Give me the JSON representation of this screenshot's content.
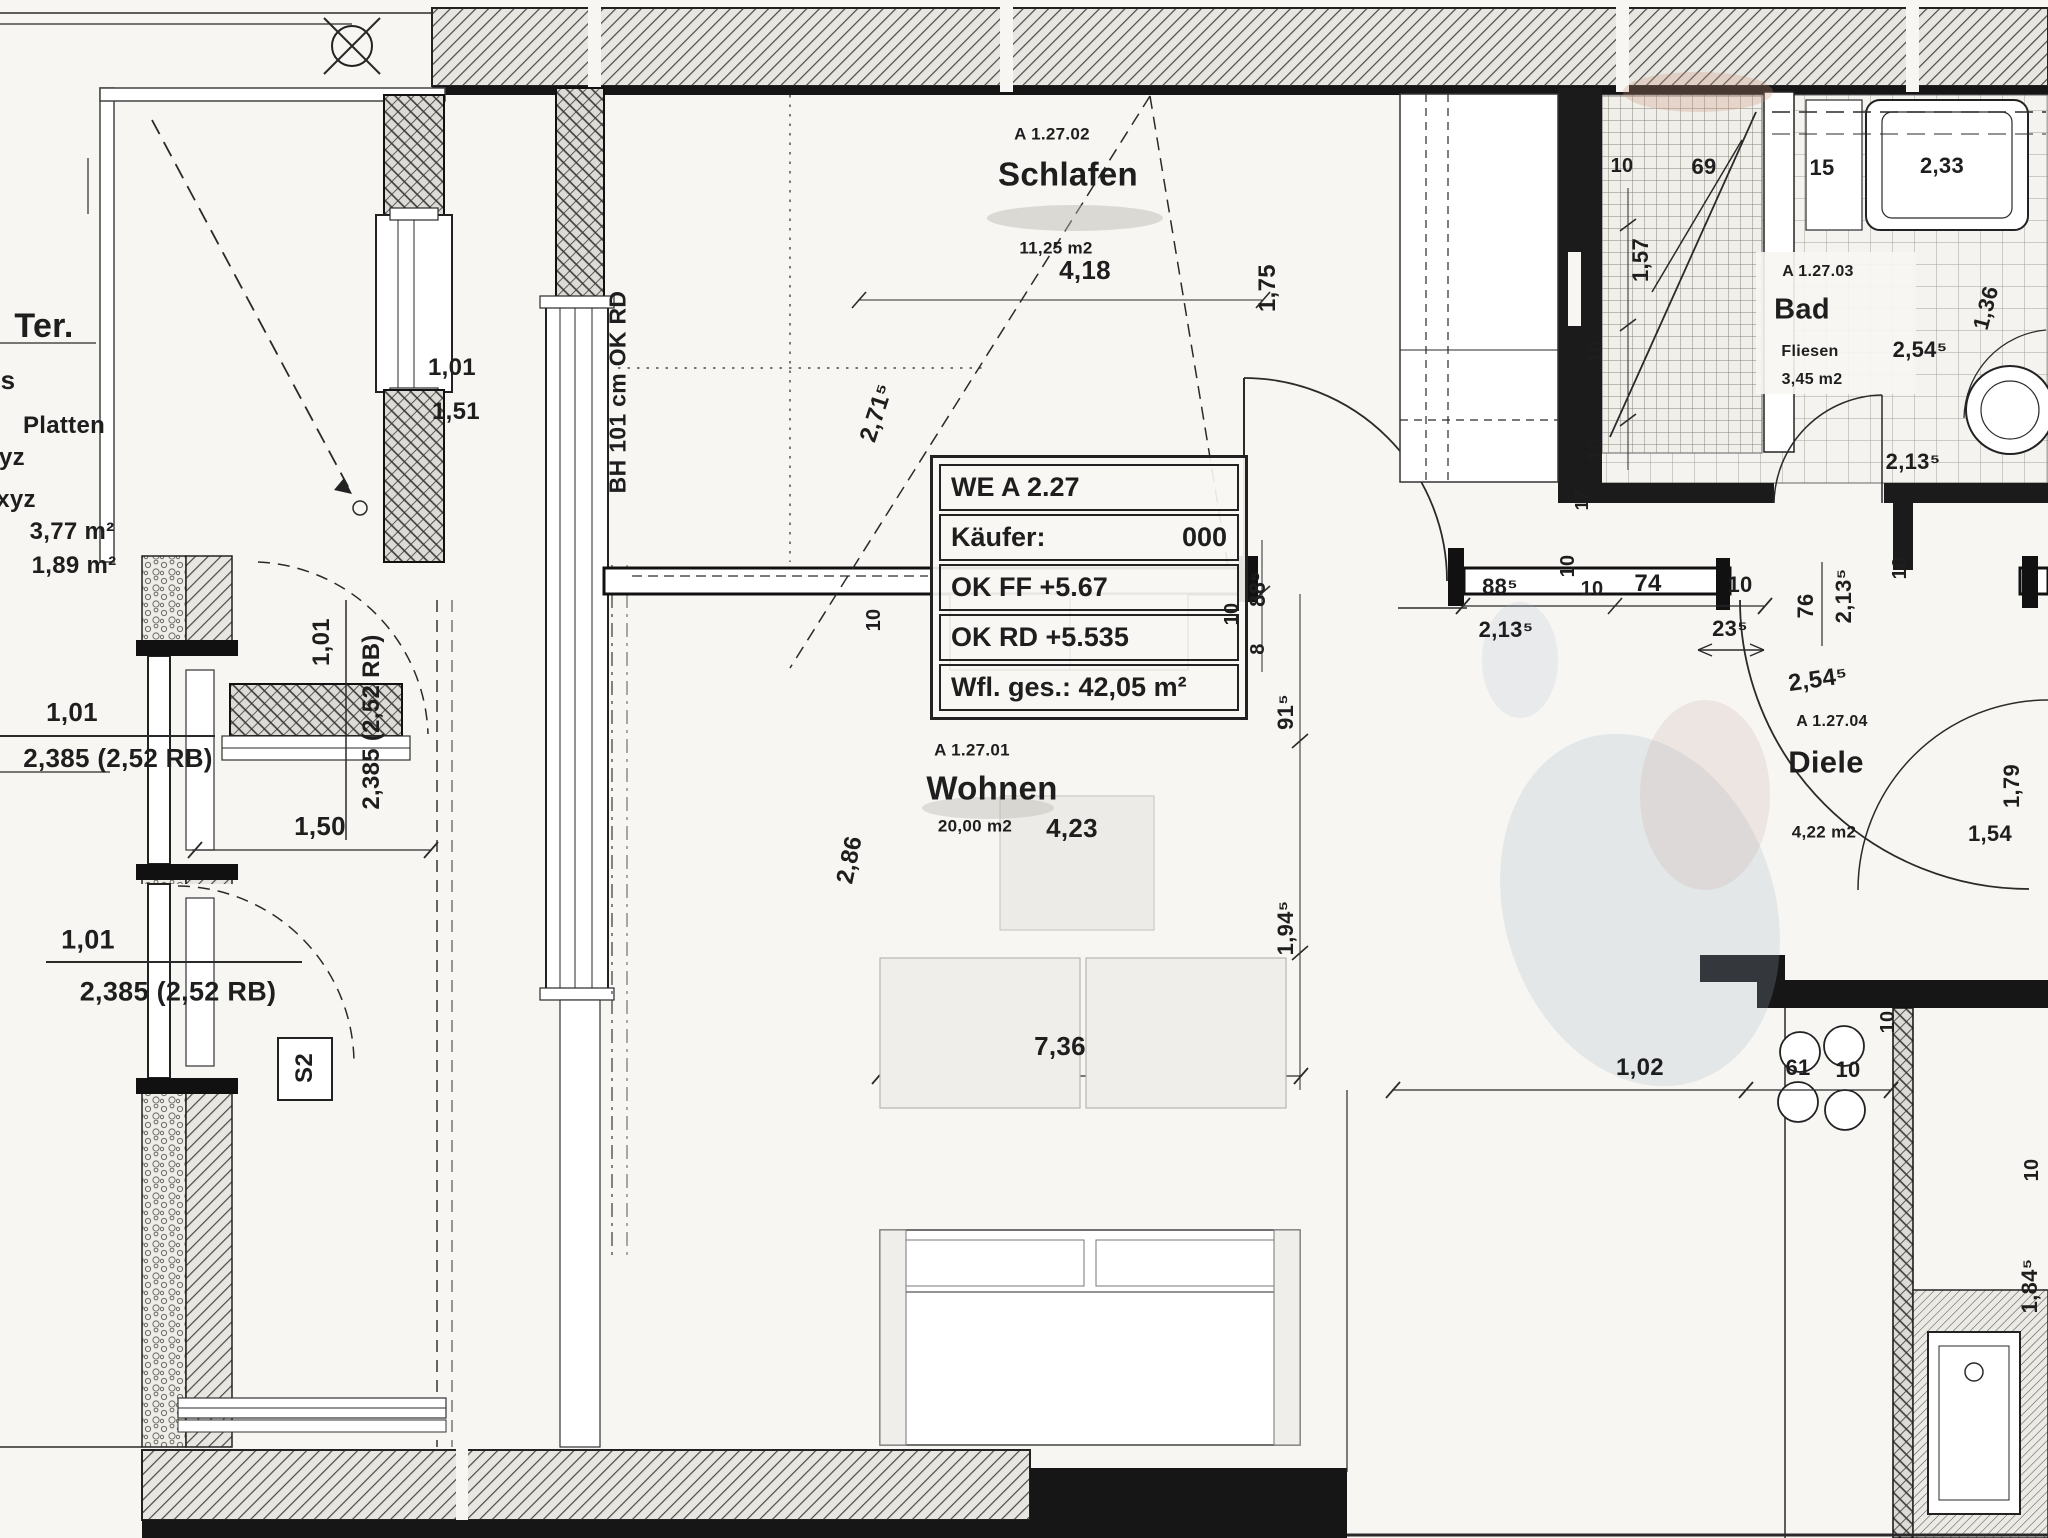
{
  "plan": {
    "colors": {
      "paper": "#f7f6f3",
      "ink": "#1c1c1c",
      "wall": "#161616",
      "smudge_blue": "#9fb0c6",
      "smudge_pink": "#c8937e"
    },
    "info_box": {
      "unit": "WE A 2.27",
      "buyer_label": "Käufer:",
      "buyer_value": "000",
      "ok_ff": "OK FF  +5.67",
      "ok_rd": "OK RD +5.535",
      "total_area": "Wfl. ges.: 42,05 m²"
    },
    "rooms": [
      {
        "id": "schlafen",
        "code": "A 1.27.02",
        "name": "Schlafen",
        "area": "11,25 m2",
        "labels": [
          {
            "f": "code",
            "x": 1052,
            "y": 134,
            "s": 17
          },
          {
            "f": "name",
            "x": 1068,
            "y": 174,
            "s": 33
          },
          {
            "f": "area",
            "x": 1056,
            "y": 248,
            "s": 17
          }
        ]
      },
      {
        "id": "wohnen",
        "code": "A 1.27.01",
        "name": "Wohnen",
        "area": "20,00 m2",
        "labels": [
          {
            "f": "code",
            "x": 972,
            "y": 750,
            "s": 17
          },
          {
            "f": "name",
            "x": 992,
            "y": 788,
            "s": 33
          },
          {
            "f": "area",
            "x": 975,
            "y": 826,
            "s": 17
          }
        ]
      },
      {
        "id": "bad",
        "code": "A 1.27.03",
        "name": "Bad",
        "floor": "Fliesen",
        "area": "3,45 m2",
        "labels": [
          {
            "f": "code",
            "x": 1818,
            "y": 272,
            "s": 16
          },
          {
            "f": "name",
            "x": 1802,
            "y": 310,
            "s": 29
          },
          {
            "f": "floor",
            "x": 1810,
            "y": 352,
            "s": 16
          },
          {
            "f": "area",
            "x": 1812,
            "y": 380,
            "s": 16
          }
        ]
      },
      {
        "id": "diele",
        "code": "A 1.27.04",
        "name": "Diele",
        "area": "4,22 m2",
        "labels": [
          {
            "f": "code",
            "x": 1832,
            "y": 722,
            "s": 16
          },
          {
            "f": "name",
            "x": 1826,
            "y": 762,
            "s": 31
          },
          {
            "f": "area",
            "x": 1824,
            "y": 832,
            "s": 17
          }
        ]
      }
    ],
    "legend": {
      "items": [
        {
          "n": "legend-ter",
          "t": "Ter.",
          "x": 44,
          "y": 326,
          "s": 34
        },
        {
          "n": "legend-s",
          "t": "s",
          "x": 8,
          "y": 380,
          "s": 26
        },
        {
          "n": "legend-platten",
          "t": "Platten",
          "x": 64,
          "y": 426,
          "s": 24
        },
        {
          "n": "legend-yz",
          "t": "yz",
          "x": 12,
          "y": 458,
          "s": 24
        },
        {
          "n": "legend-xyz",
          "t": "xyz",
          "x": 16,
          "y": 500,
          "s": 24
        },
        {
          "n": "legend-area-1",
          "t": "3,77 m²",
          "x": 72,
          "y": 532,
          "s": 24
        },
        {
          "n": "legend-area-2",
          "t": "1,89 m²",
          "x": 74,
          "y": 566,
          "s": 24
        }
      ]
    },
    "labels": [
      {
        "n": "dim-terrace-window-w",
        "t": "1,01",
        "x": 452,
        "y": 368,
        "s": 24,
        "r": 0
      },
      {
        "n": "dim-terrace-window-h",
        "t": "1,51",
        "x": 456,
        "y": 412,
        "s": 24,
        "r": 0
      },
      {
        "n": "note-window-bh",
        "t": "BH 101 cm OK RD",
        "x": 618,
        "y": 392,
        "s": 23,
        "r": -90
      },
      {
        "n": "dim-balcony-door-w",
        "t": "1,01",
        "x": 322,
        "y": 642,
        "s": 24,
        "r": -90
      },
      {
        "n": "dim-balcony-door-h",
        "t": "2,385 (2,52 RB)",
        "x": 372,
        "y": 722,
        "s": 24,
        "r": -90
      },
      {
        "n": "dim-west-window1-w",
        "t": "1,01",
        "x": 72,
        "y": 712,
        "s": 26,
        "r": 0
      },
      {
        "n": "dim-west-window1-h",
        "t": "2,385 (2,52 RB)",
        "x": 118,
        "y": 758,
        "s": 26,
        "r": 0
      },
      {
        "n": "dim-west-window2-w",
        "t": "1,01",
        "x": 88,
        "y": 940,
        "s": 27,
        "r": 0
      },
      {
        "n": "dim-west-window2-h",
        "t": "2,385 (2,52 RB)",
        "x": 178,
        "y": 992,
        "s": 27,
        "r": 0
      },
      {
        "n": "dim-terrace-width",
        "t": "1,50",
        "x": 320,
        "y": 826,
        "s": 26,
        "r": 0
      },
      {
        "n": "label-s2",
        "t": "S2",
        "x": 305,
        "y": 1068,
        "s": 24,
        "r": -90
      },
      {
        "n": "dim-schlafen-width",
        "t": "4,18",
        "x": 1085,
        "y": 270,
        "s": 26,
        "r": 0
      },
      {
        "n": "dim-schlafen-right",
        "t": "1,75",
        "x": 1268,
        "y": 288,
        "s": 24,
        "r": -90
      },
      {
        "n": "dim-schlafen-diag",
        "t": "2,71⁵",
        "x": 877,
        "y": 413,
        "s": 24,
        "r": -72
      },
      {
        "n": "dim-door1-left",
        "t": "88⁵",
        "x": 1258,
        "y": 589,
        "s": 22,
        "r": -90
      },
      {
        "n": "dim-wall-8",
        "t": "8",
        "x": 1258,
        "y": 649,
        "s": 20,
        "r": -90
      },
      {
        "n": "dim-wall-10-left",
        "t": "10",
        "x": 1232,
        "y": 614,
        "s": 20,
        "r": -90
      },
      {
        "n": "dim-wohnen-91",
        "t": "91⁵",
        "x": 1286,
        "y": 712,
        "s": 22,
        "r": -90
      },
      {
        "n": "dim-wohnen-194",
        "t": "1,94⁵",
        "x": 1286,
        "y": 928,
        "s": 22,
        "r": -90
      },
      {
        "n": "dim-wohnen-10",
        "t": "10",
        "x": 874,
        "y": 620,
        "s": 20,
        "r": -90
      },
      {
        "n": "dim-wohnen-width",
        "t": "4,23",
        "x": 1072,
        "y": 828,
        "s": 26,
        "r": 0
      },
      {
        "n": "dim-wohnen-diag",
        "t": "2,86",
        "x": 850,
        "y": 860,
        "s": 24,
        "r": -78
      },
      {
        "n": "dim-couch",
        "t": "7,36",
        "x": 1060,
        "y": 1046,
        "s": 26,
        "r": 0
      },
      {
        "n": "dim-door1-width",
        "t": "88⁵",
        "x": 1500,
        "y": 587,
        "s": 22,
        "r": 0
      },
      {
        "n": "dim-door1-total",
        "t": "2,13⁵",
        "x": 1506,
        "y": 630,
        "s": 22,
        "r": 0
      },
      {
        "n": "dim-flur-17",
        "t": "17",
        "x": 1582,
        "y": 500,
        "s": 18,
        "r": -90
      },
      {
        "n": "dim-flur-10-v",
        "t": "10",
        "x": 1568,
        "y": 566,
        "s": 20,
        "r": -90
      },
      {
        "n": "dim-flur-10-h1",
        "t": "10",
        "x": 1592,
        "y": 589,
        "s": 20,
        "r": 0
      },
      {
        "n": "dim-flur-74",
        "t": "74",
        "x": 1648,
        "y": 584,
        "s": 24,
        "r": 0
      },
      {
        "n": "dim-flur-10-h2",
        "t": "10",
        "x": 1740,
        "y": 585,
        "s": 22,
        "r": 0
      },
      {
        "n": "dim-flur-23",
        "t": "23⁵",
        "x": 1730,
        "y": 629,
        "s": 22,
        "r": 0
      },
      {
        "n": "dim-baddoor-76",
        "t": "76",
        "x": 1806,
        "y": 606,
        "s": 22,
        "r": -90
      },
      {
        "n": "dim-baddoor-213",
        "t": "2,13⁵",
        "x": 1844,
        "y": 596,
        "s": 22,
        "r": -90
      },
      {
        "n": "dim-diele-254",
        "t": "2,54⁵",
        "x": 1818,
        "y": 680,
        "s": 24,
        "r": -8
      },
      {
        "n": "dim-diele-10",
        "t": "10",
        "x": 1900,
        "y": 568,
        "s": 20,
        "r": -90
      },
      {
        "n": "dim-diele-179",
        "t": "1,79",
        "x": 2012,
        "y": 786,
        "s": 22,
        "r": -90
      },
      {
        "n": "dim-diele-154",
        "t": "1,54",
        "x": 1990,
        "y": 834,
        "s": 22,
        "r": 0
      },
      {
        "n": "dim-bad-10a",
        "t": "10",
        "x": 1622,
        "y": 166,
        "s": 20,
        "r": 0
      },
      {
        "n": "dim-bad-69",
        "t": "69",
        "x": 1704,
        "y": 167,
        "s": 22,
        "r": 0
      },
      {
        "n": "dim-bad-15",
        "t": "15",
        "x": 1822,
        "y": 168,
        "s": 22,
        "r": 0
      },
      {
        "n": "dim-bad-233",
        "t": "2,33",
        "x": 1942,
        "y": 166,
        "s": 22,
        "r": 0
      },
      {
        "n": "dim-bad-157",
        "t": "1,57",
        "x": 1641,
        "y": 260,
        "s": 22,
        "r": -90
      },
      {
        "n": "dim-bad-10b",
        "t": "10",
        "x": 1596,
        "y": 352,
        "s": 20,
        "r": -90
      },
      {
        "n": "dim-bad-10c",
        "t": "10",
        "x": 1596,
        "y": 450,
        "s": 20,
        "r": -90
      },
      {
        "n": "dim-bad-136",
        "t": "1,36",
        "x": 1986,
        "y": 308,
        "s": 22,
        "r": -75
      },
      {
        "n": "dim-bad-254",
        "t": "2,54⁵",
        "x": 1920,
        "y": 350,
        "s": 22,
        "r": 0
      },
      {
        "n": "dim-bad-213b",
        "t": "2,13⁵",
        "x": 1913,
        "y": 462,
        "s": 22,
        "r": 0
      },
      {
        "n": "dim-kitchen-102",
        "t": "1,02",
        "x": 1640,
        "y": 1068,
        "s": 24,
        "r": 0
      },
      {
        "n": "dim-kitchen-61",
        "t": "61",
        "x": 1798,
        "y": 1068,
        "s": 22,
        "r": 0
      },
      {
        "n": "dim-kitchen-10a",
        "t": "10",
        "x": 1848,
        "y": 1070,
        "s": 22,
        "r": 0
      },
      {
        "n": "dim-kitchen-10b",
        "t": "10",
        "x": 1888,
        "y": 1022,
        "s": 20,
        "r": -90
      },
      {
        "n": "dim-kitchen-10c",
        "t": "10",
        "x": 2032,
        "y": 1170,
        "s": 20,
        "r": -90
      },
      {
        "n": "dim-kitchen-184",
        "t": "1,84⁵",
        "x": 2030,
        "y": 1286,
        "s": 22,
        "r": -90
      }
    ]
  }
}
